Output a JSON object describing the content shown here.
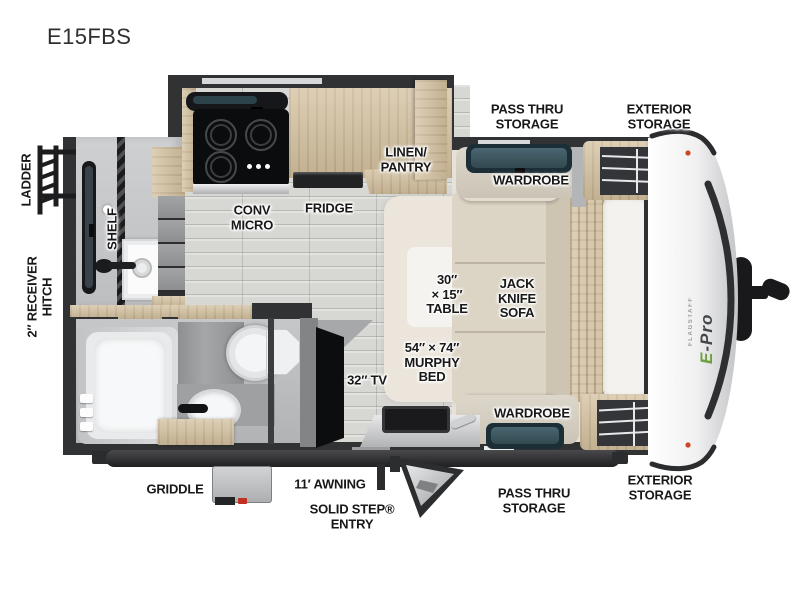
{
  "title": "E15FBS",
  "floorplan": {
    "exterior_labels": {
      "ladder": "LADDER",
      "receiver_hitch": "2″ RECEIVER\nHITCH",
      "pass_thru_storage_top": "PASS THRU\nSTORAGE",
      "exterior_storage_top": "EXTERIOR\nSTORAGE",
      "pass_thru_storage_bottom": "PASS THRU\nSTORAGE",
      "exterior_storage_bottom": "EXTERIOR\nSTORAGE",
      "griddle": "GRIDDLE",
      "awning": "11′ AWNING",
      "step_entry": "SOLID STEP®\nENTRY"
    },
    "interior_labels": {
      "shelf": "SHELF",
      "conv_micro": "CONV\nMICRO",
      "fridge": "FRIDGE",
      "linen_pantry": "LINEN/\nPANTRY",
      "wardrobe_top": "WARDROBE",
      "wardrobe_bottom": "WARDROBE",
      "table": "30″\n× 15″\nTABLE",
      "jack_knife_sofa": "JACK\nKNIFE\nSOFA",
      "murphy_bed": "54″ × 74″\nMURPHY\nBED",
      "tv": "32″ TV"
    },
    "brand": {
      "model_line": "E-Pro",
      "series": "FLAGSTAFF"
    },
    "colors": {
      "wall": "#313234",
      "wood": "#d2bf9d",
      "floor": "#d7d7d3",
      "front_floor": "#e7e2d9",
      "fabric": "#dcd4c5",
      "window_glass": "#3a545e",
      "accent_green": "#6f9d3f",
      "label_text": "#181818"
    }
  }
}
